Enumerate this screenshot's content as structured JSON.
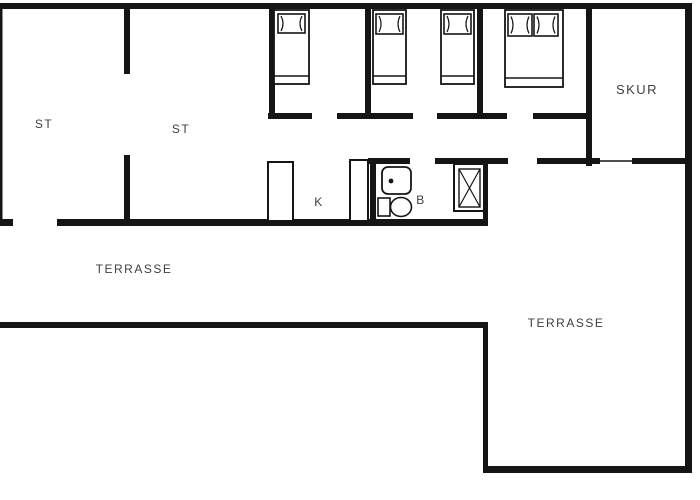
{
  "floor_plan": {
    "title": "summerhouse floor plan",
    "labels": {
      "living_room_1": "ST",
      "living_room_2": "ST",
      "kitchen": "K",
      "bathroom": "B",
      "shed": "SKUR",
      "terrace_left": "TERRASSE",
      "terrace_right": "TERRASSE"
    },
    "rooms": [
      {
        "name": "living-room-1",
        "label": "ST"
      },
      {
        "name": "living-room-2",
        "label": "ST"
      },
      {
        "name": "bedroom-1",
        "label": ""
      },
      {
        "name": "shared-bedroom",
        "label": ""
      },
      {
        "name": "double-bedroom",
        "label": ""
      },
      {
        "name": "kitchen",
        "label": "K"
      },
      {
        "name": "bathroom",
        "label": "B"
      },
      {
        "name": "shed",
        "label": "SKUR"
      },
      {
        "name": "terrace-left",
        "label": "TERRASSE"
      },
      {
        "name": "terrace-right",
        "label": "TERRASSE"
      }
    ],
    "furniture": [
      {
        "name": "single-bed",
        "room": "bedroom-1"
      },
      {
        "name": "single-bed",
        "room": "shared-bedroom"
      },
      {
        "name": "single-bed",
        "room": "shared-bedroom"
      },
      {
        "name": "double-bed",
        "room": "double-bedroom"
      },
      {
        "name": "kitchen-counter",
        "room": "kitchen"
      },
      {
        "name": "kitchen-counter",
        "room": "kitchen"
      },
      {
        "name": "washbasin",
        "room": "bathroom"
      },
      {
        "name": "toilet",
        "room": "bathroom"
      },
      {
        "name": "shower-cabin",
        "room": "bathroom"
      }
    ],
    "colors": {
      "wall": "#151515",
      "background": "#ffffff",
      "text": "#3f3f3f",
      "door_threshold": "#aaaaaa"
    }
  }
}
